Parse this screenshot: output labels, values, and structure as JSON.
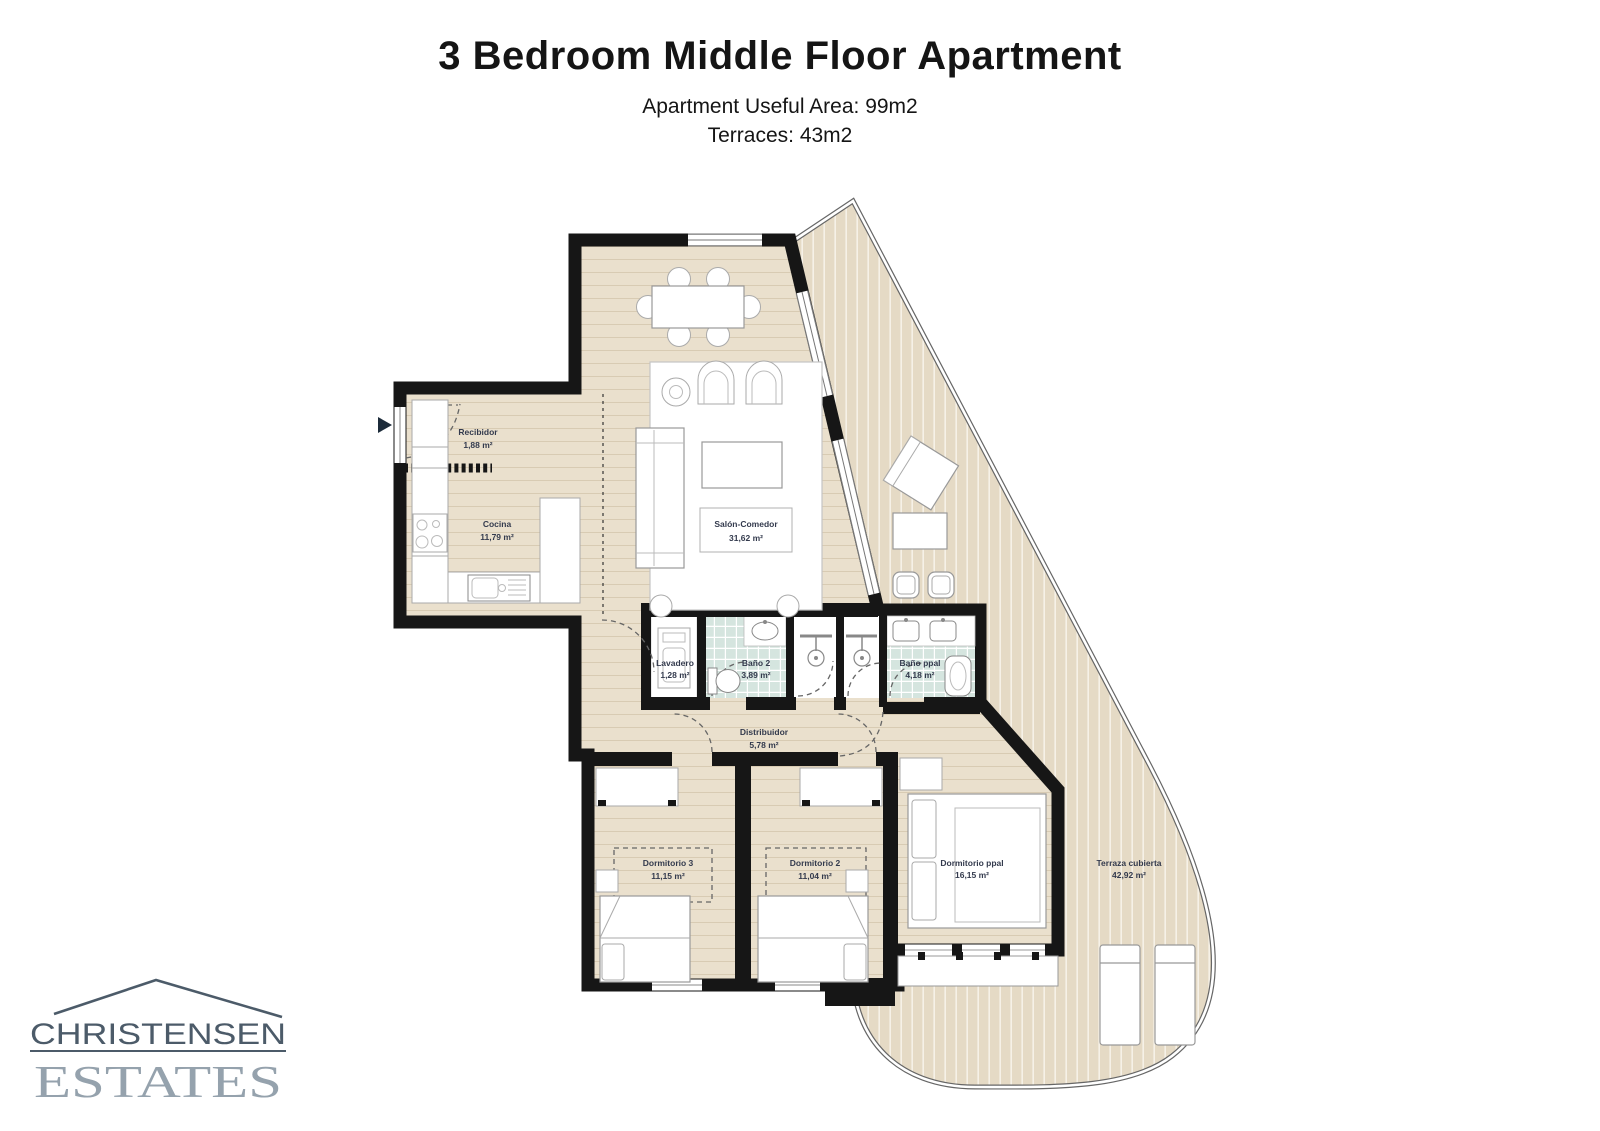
{
  "header": {
    "title": "3 Bedroom Middle Floor Apartment",
    "useful_area_label": "Apartment Useful Area:  99m2",
    "terraces_label": "Terraces: 43m2"
  },
  "logo": {
    "name_line": "CHRISTENSEN",
    "type_line": "ESTATES"
  },
  "floorplan": {
    "rooms": {
      "recibidor": {
        "name": "Recibidor",
        "area": "1,88 m²"
      },
      "cocina": {
        "name": "Cocina",
        "area": "11,79 m²"
      },
      "salon_comedor": {
        "name": "Salón-Comedor",
        "area": "31,62 m²"
      },
      "lavadero": {
        "name": "Lavadero",
        "area": "1,28 m²"
      },
      "bano2": {
        "name": "Baño 2",
        "area": "3,89 m²"
      },
      "bano_ppal": {
        "name": "Baño ppal",
        "area": "4,18 m²"
      },
      "distribuidor": {
        "name": "Distribuidor",
        "area": "5,78 m²"
      },
      "dormitorio3": {
        "name": "Dormitorio 3",
        "area": "11,15 m²"
      },
      "dormitorio2": {
        "name": "Dormitorio 2",
        "area": "11,04 m²"
      },
      "dormitorio_ppal": {
        "name": "Dormitorio ppal",
        "area": "16,15 m²"
      },
      "terraza": {
        "name": "Terraza cubierta",
        "area": "42,92 m²"
      }
    },
    "colors": {
      "wall": "#161616",
      "wood_floor": "#eae0cd",
      "wood_plank_line": "#d8cbb3",
      "terrace_deck": "#e5dac5",
      "terrace_deck_line": "#f6f1e7",
      "bathroom_tile": "#d5e5df",
      "room_label": "#333a4d",
      "railing": "#666666",
      "logo_primary": "#4c5b69",
      "logo_secondary": "#95a2ad"
    }
  }
}
